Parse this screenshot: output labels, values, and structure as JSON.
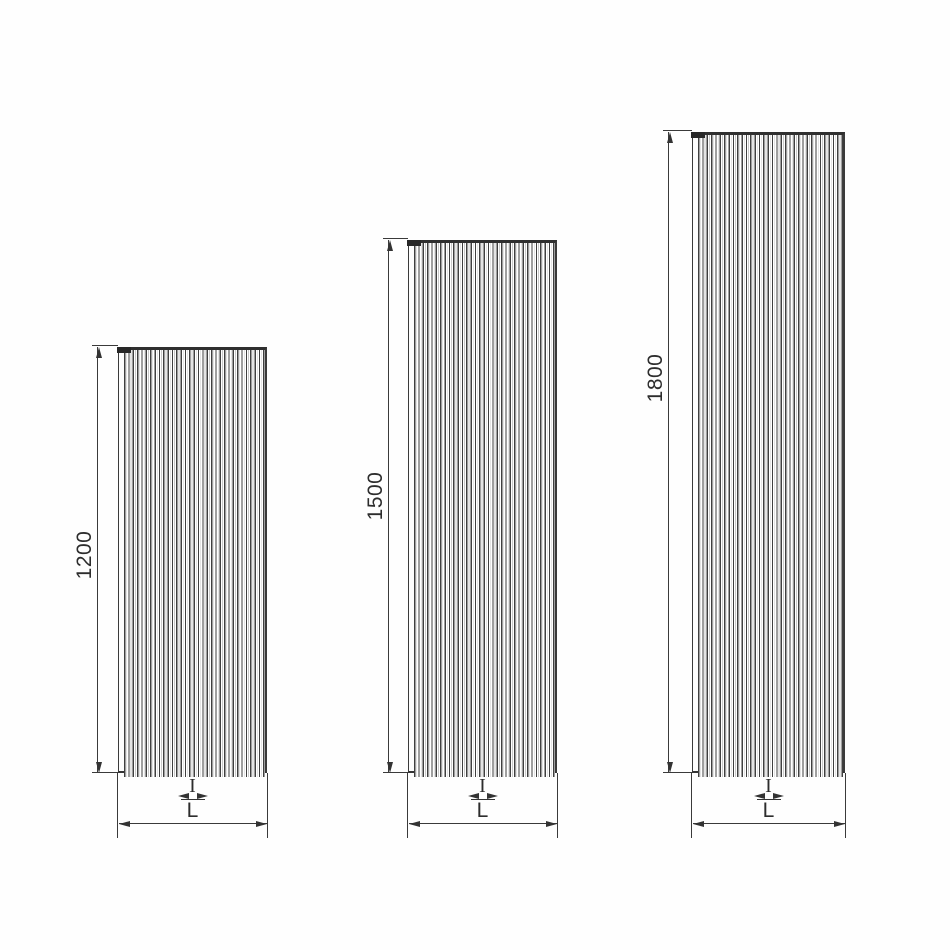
{
  "diagram": {
    "type": "technical-drawing",
    "description": "Dimensional line drawing of three vertical finned radiator panels of increasing height, each with a rotated height dimension, a central connection-spacing dimension I, and an overall width dimension L",
    "line_color": "#3a3a3a",
    "background_color": "#fefefe",
    "heights_mm": [
      1200,
      1500,
      1800
    ],
    "panels": [
      {
        "height_label": "1200",
        "height_mm": 1200,
        "spacing_label": "I",
        "width_label": "L"
      },
      {
        "height_label": "1500",
        "height_mm": 1500,
        "spacing_label": "I",
        "width_label": "L"
      },
      {
        "height_label": "1800",
        "height_mm": 1800,
        "spacing_label": "I",
        "width_label": "L"
      }
    ]
  }
}
